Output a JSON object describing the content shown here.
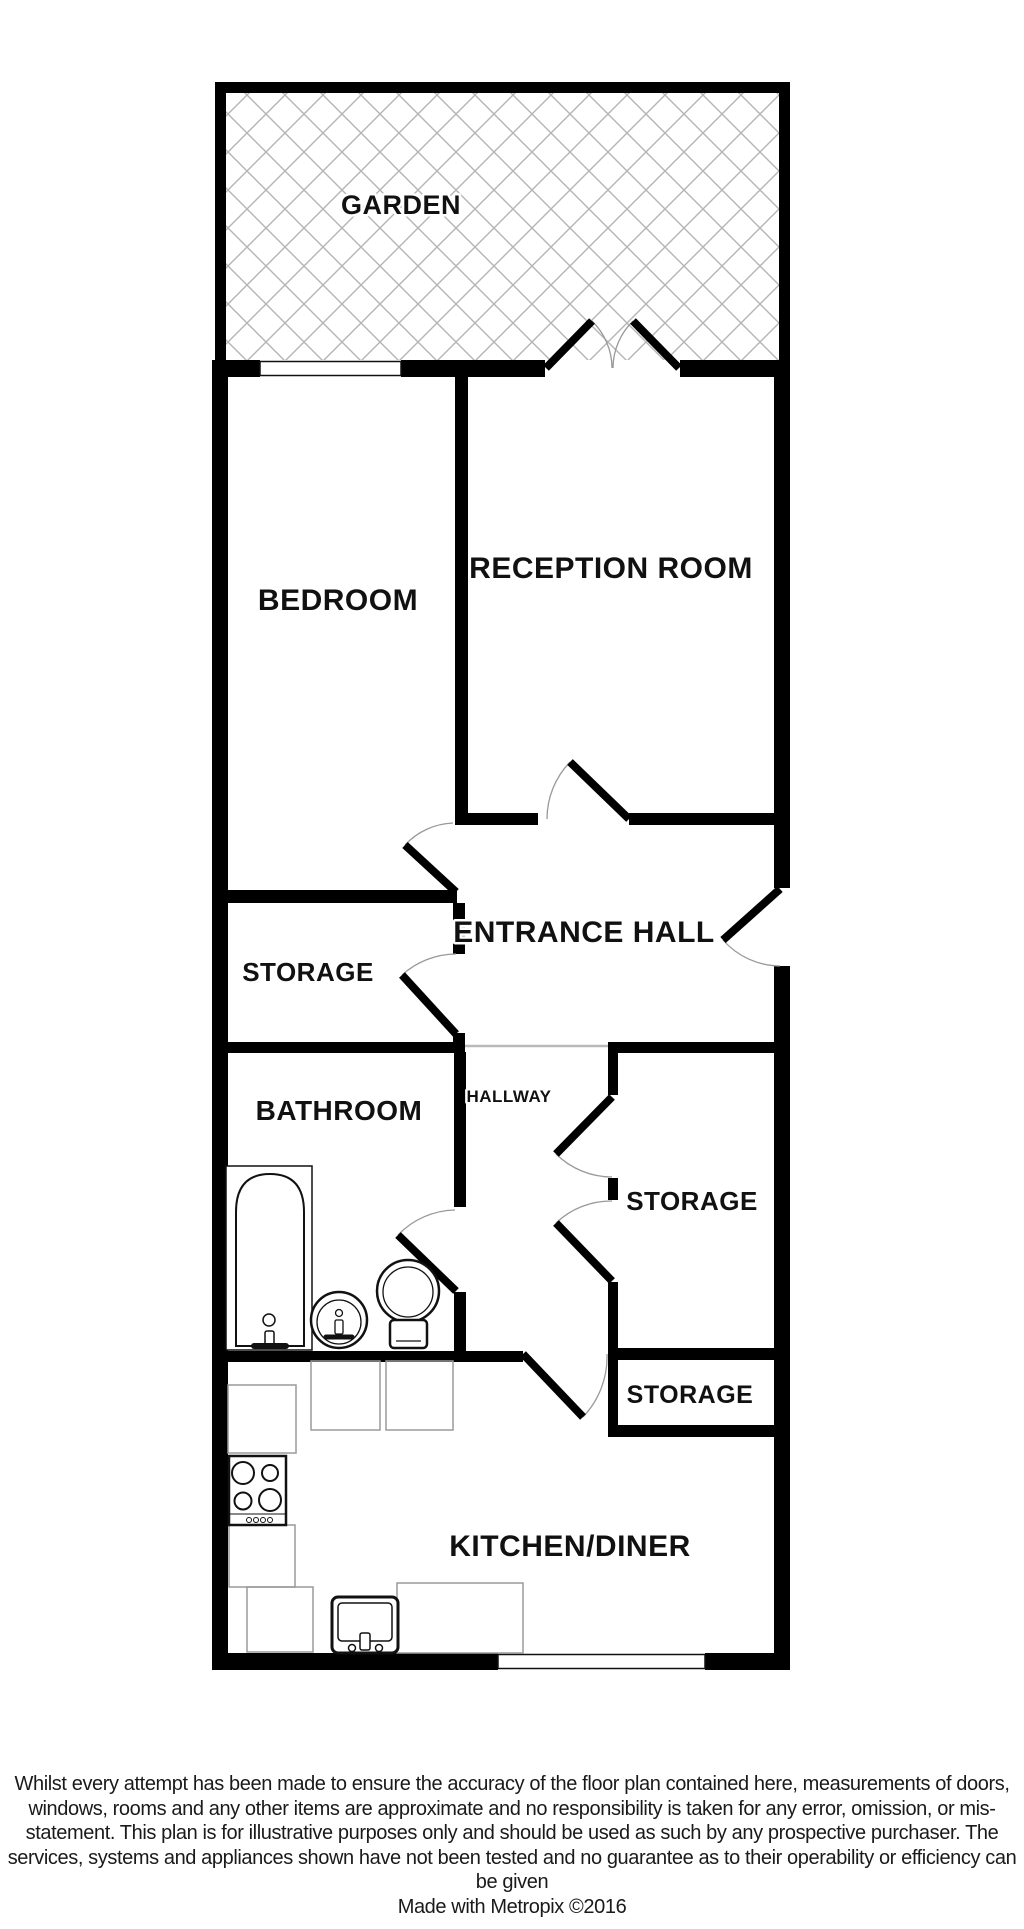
{
  "plan": {
    "rooms": [
      {
        "name": "garden",
        "label": "GARDEN"
      },
      {
        "name": "bedroom",
        "label": "BEDROOM"
      },
      {
        "name": "reception-room",
        "label": "RECEPTION ROOM"
      },
      {
        "name": "entrance-hall",
        "label": "ENTRANCE HALL"
      },
      {
        "name": "storage-upper",
        "label": "STORAGE"
      },
      {
        "name": "bathroom",
        "label": "BATHROOM"
      },
      {
        "name": "hallway",
        "label": "HALLWAY"
      },
      {
        "name": "storage-middle",
        "label": "STORAGE"
      },
      {
        "name": "storage-lower",
        "label": "STORAGE"
      },
      {
        "name": "kitchen-diner",
        "label": "KITCHEN/DINER"
      }
    ],
    "fixtures": [
      "bathtub",
      "pedestal-sink",
      "toilet",
      "hob",
      "kitchen-sink",
      "worktops"
    ],
    "colors": {
      "wall": "#000000",
      "hatch": "#b5b5b5",
      "door_arc": "#999999",
      "counter_outline": "#9a9a9a",
      "label_text": "#111111"
    }
  },
  "footer": {
    "disclaimer": "Whilst every attempt has been made to ensure the accuracy of the floor plan contained here, measurements of doors, windows, rooms and any other items are approximate and no responsibility is taken for any error, omission, or mis-statement. This plan is for illustrative purposes only and should be used as such by any prospective purchaser. The services, systems and appliances shown have not been tested and no guarantee as to their operability or efficiency can be given",
    "attribution": "Made with Metropix ©2016"
  }
}
